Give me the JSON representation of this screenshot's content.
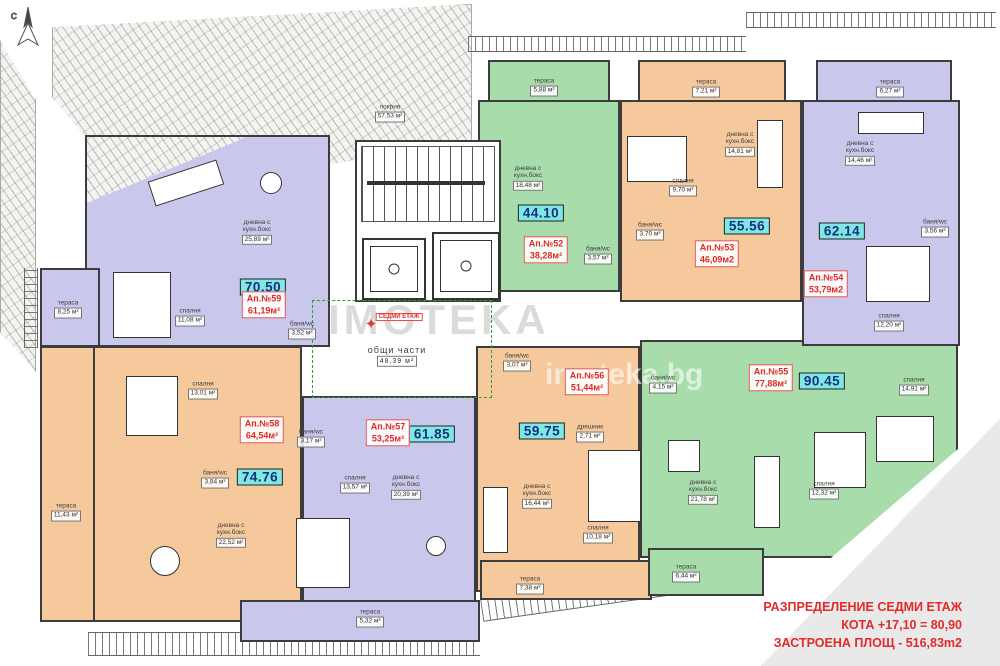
{
  "title_block": {
    "line1": "РАЗПРЕДЕЛЕНИЕ  СЕДМИ ЕТАЖ",
    "line2": "КОТА +17,10 = 80,90",
    "line3": "ЗАСТРОЕНА ПЛОЩ - 516,83m2"
  },
  "common": {
    "roof_name": "покрив",
    "roof_area": "57,53 м²",
    "lobby_name": "общи части",
    "lobby_area": "48,39 м²",
    "floor_tag": "СЕДМИ ЕТАЖ",
    "compass": "С"
  },
  "watermarks": {
    "wm1": "IMOTEKA",
    "wm2": "imoteka.bg"
  },
  "colors": {
    "purple_apartment": "#c9c7ec",
    "orange_apartment": "#f5c99b",
    "green_apartment": "#a8dcaa",
    "area_badge_teal": "#7fe8e4",
    "apartment_badge_red": "#e03434",
    "title_red": "#e22a2a"
  },
  "apartments": [
    {
      "number": "Ап.№52",
      "total": "38,28м²",
      "badge": "44.10",
      "color": "green",
      "rooms": [
        {
          "name": "тераса",
          "area": "5,88 м²"
        },
        {
          "name": "дневна с кухн.бокс",
          "area": "18,48 м²"
        },
        {
          "name": "баня/wc",
          "area": "3,57 м²"
        }
      ]
    },
    {
      "number": "Ап.№53",
      "total": "46,09м2",
      "badge": "55.56",
      "color": "orange",
      "rooms": [
        {
          "name": "тераса",
          "area": "7,21 м²"
        },
        {
          "name": "дневна с кухн.бокс",
          "area": "14,81 м²"
        },
        {
          "name": "спалня",
          "area": "9,70 м²"
        },
        {
          "name": "баня/wc",
          "area": "3,70 м²"
        }
      ]
    },
    {
      "number": "Ап.№54",
      "total": "53,79м2",
      "badge": "62.14",
      "color": "purple",
      "rooms": [
        {
          "name": "тераса",
          "area": "6,27 м²"
        },
        {
          "name": "дневна с кухн.бокс",
          "area": "14,46 м²"
        },
        {
          "name": "баня/wc",
          "area": "3,56 м²"
        },
        {
          "name": "спалня",
          "area": "12,20 м²"
        }
      ]
    },
    {
      "number": "Ап.№55",
      "total": "77,88м²",
      "badge": "90.45",
      "color": "green",
      "rooms": [
        {
          "name": "баня/wc",
          "area": "4,15 м²"
        },
        {
          "name": "спалня",
          "area": "14,91 м²"
        },
        {
          "name": "дневна с кухн.бокс",
          "area": "21,78 м²"
        },
        {
          "name": "спалня",
          "area": "12,32 м²"
        },
        {
          "name": "тераса",
          "area": "6,44 м²"
        }
      ]
    },
    {
      "number": "Ап.№56",
      "total": "51,44м²",
      "badge": "59.75",
      "color": "orange",
      "rooms": [
        {
          "name": "баня/wc",
          "area": "3,07 м²"
        },
        {
          "name": "дрешник",
          "area": "2,71 м²"
        },
        {
          "name": "дневна с кухн.бокс",
          "area": "16,44 м²"
        },
        {
          "name": "спалня",
          "area": "10,18 м²"
        },
        {
          "name": "тераса",
          "area": "7,38 м²"
        }
      ]
    },
    {
      "number": "Ап.№57",
      "total": "53,25м²",
      "badge": "61.85",
      "color": "purple",
      "rooms": [
        {
          "name": "баня/wc",
          "area": "3,17 м²"
        },
        {
          "name": "спалня",
          "area": "13,57 м²"
        },
        {
          "name": "дневна с кухн.бокс",
          "area": "20,39 м²"
        },
        {
          "name": "тераса",
          "area": "5,32 м²"
        }
      ]
    },
    {
      "number": "Ап.№58",
      "total": "64,54м²",
      "badge": "74.76",
      "color": "orange",
      "rooms": [
        {
          "name": "спалня",
          "area": "13,01 м²"
        },
        {
          "name": "баня/wc",
          "area": "3,84 м²"
        },
        {
          "name": "дневна с кухн.бокс",
          "area": "22,52 м²"
        },
        {
          "name": "тераса",
          "area": "11,43 м²"
        }
      ]
    },
    {
      "number": "Ап.№59",
      "total": "61,19м²",
      "badge": "70.50",
      "color": "purple",
      "rooms": [
        {
          "name": "дневна с кухн.бокс",
          "area": "25,89 м²"
        },
        {
          "name": "спалня",
          "area": "11,08 м²"
        },
        {
          "name": "баня/wc",
          "area": "3,52 м²"
        },
        {
          "name": "тераса",
          "area": "8,25 м²"
        }
      ]
    }
  ]
}
